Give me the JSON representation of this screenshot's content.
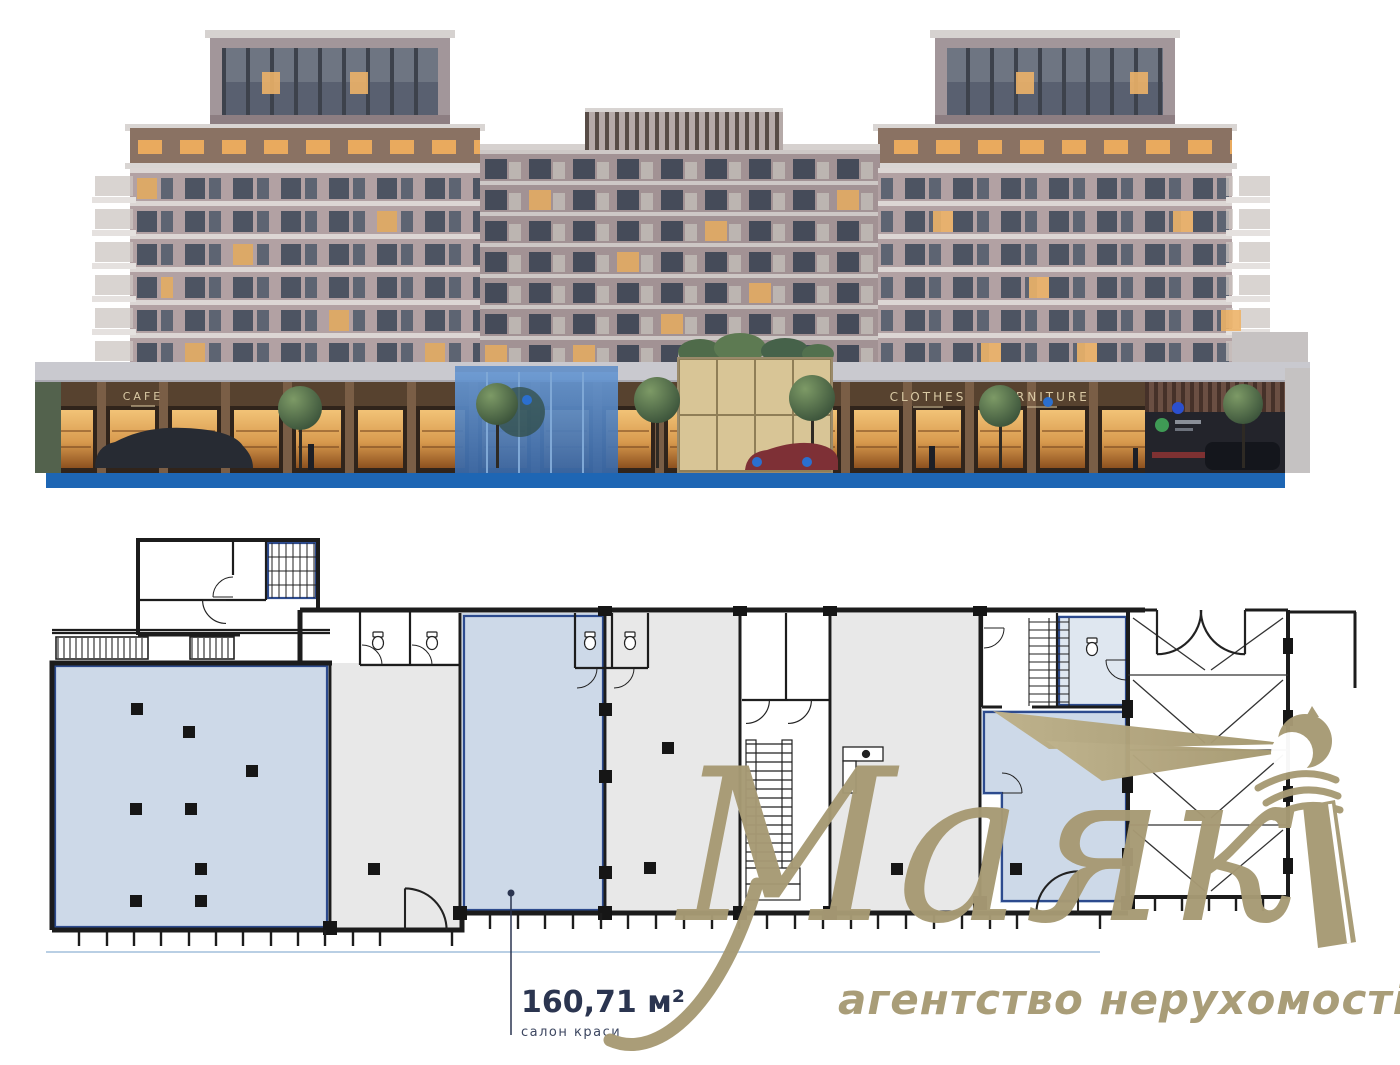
{
  "page": {
    "width": 1400,
    "height": 1065,
    "background": "#ffffff"
  },
  "building": {
    "signs": {
      "cafe": "CAFE",
      "clothes": "CLOTHES",
      "furniture": "FURNITURE"
    },
    "base_strip_color": "#1e66b4"
  },
  "floor_plan": {
    "highlight_label": {
      "area": "160,71 м²",
      "purpose": "салон краси"
    },
    "colors": {
      "available_fill": "#cdd9e8",
      "other_fill": "#e8e8e8",
      "wall": "#1c1c1c",
      "accent_wall": "#2d4b8e",
      "label_text": "#2b3550"
    }
  },
  "brand": {
    "name": "Маяк",
    "tagline": "агентство нерухомості",
    "color": "#a79a74"
  }
}
